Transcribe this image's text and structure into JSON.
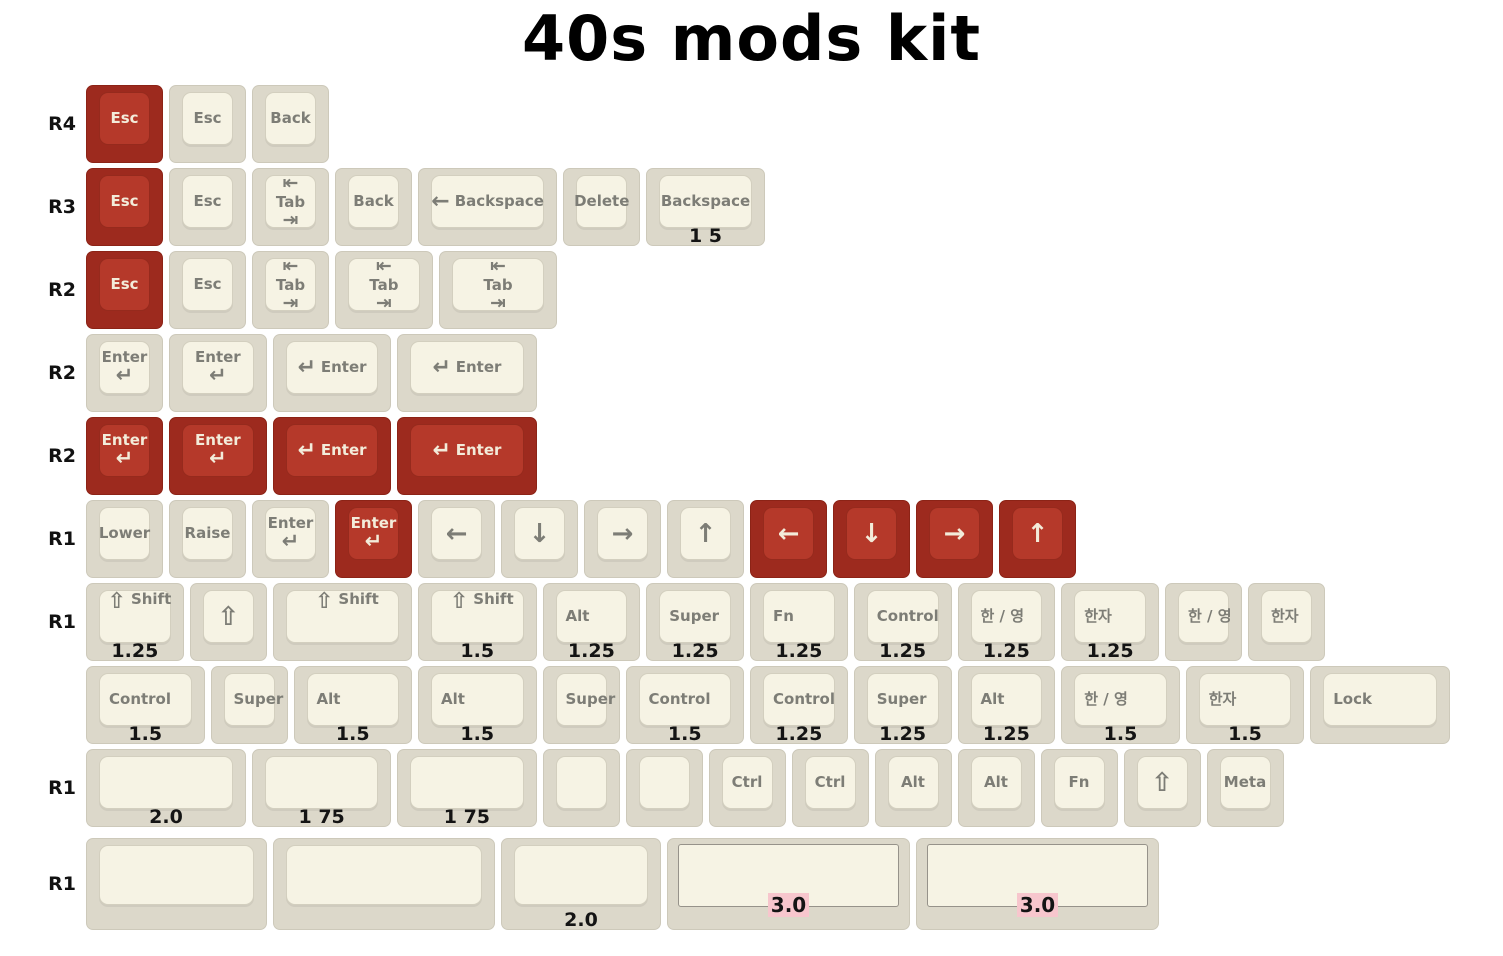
{
  "title": "40s mods kit",
  "colors": {
    "red_base": "#9d2a1e",
    "red_top": "#b5392a",
    "red_text": "#f3ecda",
    "cream_base": "#dcd8ca",
    "cream_top": "#f6f3e4",
    "cream_text": "#7d7d76",
    "size_label": "#141414",
    "label_highlight": "#f7c6cd",
    "title_text": "#000000",
    "background": "#ffffff"
  },
  "rows": [
    {
      "label": "R4",
      "keys": [
        {
          "name": "keycap-esc-red",
          "type": "text",
          "color": "red",
          "w": 1,
          "legend": "Esc"
        },
        {
          "name": "keycap-esc",
          "type": "text",
          "color": "cream",
          "w": 1,
          "legend": "Esc"
        },
        {
          "name": "keycap-back",
          "type": "text",
          "color": "cream",
          "w": 1,
          "legend": "Back"
        }
      ]
    },
    {
      "label": "R3",
      "keys": [
        {
          "name": "keycap-esc-red",
          "type": "text",
          "color": "red",
          "w": 1,
          "legend": "Esc"
        },
        {
          "name": "keycap-esc",
          "type": "text",
          "color": "cream",
          "w": 1,
          "legend": "Esc"
        },
        {
          "name": "keycap-tab",
          "type": "tab",
          "color": "cream",
          "w": 1,
          "legends": [
            "⇤",
            "Tab",
            "⇥"
          ]
        },
        {
          "name": "keycap-back",
          "type": "text",
          "color": "cream",
          "w": 1,
          "legend": "Back"
        },
        {
          "name": "keycap-backspace-arrow",
          "type": "combo",
          "color": "cream",
          "w": 1.75,
          "glyph": "←",
          "glyph_name": "backspace-arrow-icon",
          "legend": "Backspace"
        },
        {
          "name": "keycap-delete",
          "type": "text",
          "color": "cream",
          "w": 1,
          "legend": "Delete"
        },
        {
          "name": "keycap-backspace",
          "type": "text",
          "color": "cream",
          "w": 1.5,
          "legend": "Backspace",
          "sz": "1 5"
        }
      ]
    },
    {
      "label": "R2",
      "keys": [
        {
          "name": "keycap-esc-red",
          "type": "text",
          "color": "red",
          "w": 1,
          "legend": "Esc"
        },
        {
          "name": "keycap-esc",
          "type": "text",
          "color": "cream",
          "w": 1,
          "legend": "Esc"
        },
        {
          "name": "keycap-tab",
          "type": "tab",
          "color": "cream",
          "w": 1,
          "legends": [
            "⇤",
            "Tab",
            "⇥"
          ]
        },
        {
          "name": "keycap-tab",
          "type": "tab",
          "color": "cream",
          "w": 1.25,
          "legends": [
            "⇤",
            "Tab",
            "⇥"
          ]
        },
        {
          "name": "keycap-tab",
          "type": "tab",
          "color": "cream",
          "w": 1.5,
          "legends": [
            "⇤",
            "Tab",
            "⇥"
          ]
        }
      ]
    },
    {
      "label": "R2",
      "keys": [
        {
          "name": "keycap-enter",
          "type": "enter2",
          "color": "cream",
          "w": 1,
          "legend": "Enter",
          "glyph": "↵",
          "glyph_name": "return-arrow-icon"
        },
        {
          "name": "keycap-enter",
          "type": "enter2",
          "color": "cream",
          "w": 1.25,
          "legend": "Enter",
          "glyph": "↵",
          "glyph_name": "return-arrow-icon"
        },
        {
          "name": "keycap-enter",
          "type": "combo",
          "color": "cream",
          "w": 1.5,
          "glyph": "↵",
          "glyph_name": "return-arrow-icon",
          "legend": "Enter"
        },
        {
          "name": "keycap-enter",
          "type": "combo",
          "color": "cream",
          "w": 1.75,
          "glyph": "↵",
          "glyph_name": "return-arrow-icon",
          "legend": "Enter"
        }
      ]
    },
    {
      "label": "R2",
      "keys": [
        {
          "name": "keycap-enter-red",
          "type": "enter2",
          "color": "red",
          "w": 1,
          "legend": "Enter",
          "glyph": "↵",
          "glyph_name": "return-arrow-icon"
        },
        {
          "name": "keycap-enter-red",
          "type": "enter2",
          "color": "red",
          "w": 1.25,
          "legend": "Enter",
          "glyph": "↵",
          "glyph_name": "return-arrow-icon"
        },
        {
          "name": "keycap-enter-red",
          "type": "combo",
          "color": "red",
          "w": 1.5,
          "glyph": "↵",
          "glyph_name": "return-arrow-icon",
          "legend": "Enter"
        },
        {
          "name": "keycap-enter-red",
          "type": "combo",
          "color": "red",
          "w": 1.75,
          "glyph": "↵",
          "glyph_name": "return-arrow-icon",
          "legend": "Enter"
        }
      ]
    },
    {
      "label": "R1",
      "keys": [
        {
          "name": "keycap-lower",
          "type": "text",
          "color": "cream",
          "w": 1,
          "legend": "Lower"
        },
        {
          "name": "keycap-raise",
          "type": "text",
          "color": "cream",
          "w": 1,
          "legend": "Raise"
        },
        {
          "name": "keycap-enter",
          "type": "enter2",
          "color": "cream",
          "w": 1,
          "legend": "Enter",
          "glyph": "↵",
          "glyph_name": "return-arrow-icon"
        },
        {
          "name": "keycap-enter-red",
          "type": "enter2",
          "color": "red",
          "w": 1,
          "legend": "Enter",
          "glyph": "↵",
          "glyph_name": "return-arrow-icon"
        },
        {
          "name": "keycap-arrow-left",
          "type": "big",
          "color": "cream",
          "w": 1,
          "glyph": "←",
          "glyph_name": "left-arrow-icon"
        },
        {
          "name": "keycap-arrow-down",
          "type": "big",
          "color": "cream",
          "w": 1,
          "glyph": "↓",
          "glyph_name": "down-arrow-icon"
        },
        {
          "name": "keycap-arrow-right",
          "type": "big",
          "color": "cream",
          "w": 1,
          "glyph": "→",
          "glyph_name": "right-arrow-icon"
        },
        {
          "name": "keycap-arrow-up",
          "type": "big",
          "color": "cream",
          "w": 1,
          "glyph": "↑",
          "glyph_name": "up-arrow-icon"
        },
        {
          "name": "keycap-arrow-left-red",
          "type": "big",
          "color": "red",
          "w": 1,
          "glyph": "←",
          "glyph_name": "left-arrow-icon"
        },
        {
          "name": "keycap-arrow-down-red",
          "type": "big",
          "color": "red",
          "w": 1,
          "glyph": "↓",
          "glyph_name": "down-arrow-icon"
        },
        {
          "name": "keycap-arrow-right-red",
          "type": "big",
          "color": "red",
          "w": 1,
          "glyph": "→",
          "glyph_name": "right-arrow-icon"
        },
        {
          "name": "keycap-arrow-up-red",
          "type": "big",
          "color": "red",
          "w": 1,
          "glyph": "↑",
          "glyph_name": "up-arrow-icon"
        }
      ]
    },
    {
      "label": "R1",
      "keys": [
        {
          "name": "keycap-shift",
          "type": "combo",
          "color": "cream",
          "w": 1.25,
          "glyph": "⇧",
          "glyph_name": "shift-arrow-icon",
          "legend": "Shift",
          "sz": "1.25",
          "align": "left"
        },
        {
          "name": "keycap-shift-icon",
          "type": "big",
          "color": "cream",
          "w": 1,
          "glyph": "⇧",
          "glyph_name": "shift-arrow-icon"
        },
        {
          "name": "keycap-shift",
          "type": "combo",
          "color": "cream",
          "w": 1.75,
          "glyph": "⇧",
          "glyph_name": "shift-arrow-icon",
          "legend": "Shift",
          "align": "left"
        },
        {
          "name": "keycap-shift",
          "type": "combo",
          "color": "cream",
          "w": 1.5,
          "glyph": "⇧",
          "glyph_name": "shift-arrow-icon",
          "legend": "Shift",
          "sz": "1.5",
          "align": "left"
        },
        {
          "name": "keycap-alt",
          "type": "text",
          "color": "cream",
          "w": 1.25,
          "legend": "Alt",
          "sz": "1.25",
          "align": "left"
        },
        {
          "name": "keycap-super",
          "type": "text",
          "color": "cream",
          "w": 1.25,
          "legend": "Super",
          "sz": "1.25",
          "align": "left"
        },
        {
          "name": "keycap-fn",
          "type": "text",
          "color": "cream",
          "w": 1.25,
          "legend": "Fn",
          "sz": "1.25",
          "align": "left"
        },
        {
          "name": "keycap-control",
          "type": "text",
          "color": "cream",
          "w": 1.25,
          "legend": "Control",
          "sz": "1.25",
          "align": "left"
        },
        {
          "name": "keycap-han-yeong",
          "type": "text",
          "color": "cream",
          "w": 1.25,
          "legend": "한 / 영",
          "sz": "1.25",
          "align": "left"
        },
        {
          "name": "keycap-hanja",
          "type": "text",
          "color": "cream",
          "w": 1.25,
          "legend": "한자",
          "sz": "1.25",
          "align": "left"
        },
        {
          "name": "keycap-han-yeong",
          "type": "text",
          "color": "cream",
          "w": 1,
          "legend": "한 / 영",
          "align": "left"
        },
        {
          "name": "keycap-hanja",
          "type": "text",
          "color": "cream",
          "w": 1,
          "legend": "한자",
          "align": "left"
        }
      ]
    },
    {
      "label": "",
      "keys": [
        {
          "name": "keycap-control",
          "type": "text",
          "color": "cream",
          "w": 1.5,
          "legend": "Control",
          "sz": "1.5",
          "align": "left"
        },
        {
          "name": "keycap-super",
          "type": "text",
          "color": "cream",
          "w": 1,
          "legend": "Super",
          "align": "left"
        },
        {
          "name": "keycap-alt",
          "type": "text",
          "color": "cream",
          "w": 1.5,
          "legend": "Alt",
          "sz": "1.5",
          "align": "left"
        },
        {
          "name": "keycap-alt",
          "type": "text",
          "color": "cream",
          "w": 1.5,
          "legend": "Alt",
          "sz": "1.5",
          "align": "left"
        },
        {
          "name": "keycap-super",
          "type": "text",
          "color": "cream",
          "w": 1,
          "legend": "Super",
          "align": "left"
        },
        {
          "name": "keycap-control",
          "type": "text",
          "color": "cream",
          "w": 1.5,
          "legend": "Control",
          "sz": "1.5",
          "align": "left"
        },
        {
          "name": "keycap-control",
          "type": "text",
          "color": "cream",
          "w": 1.25,
          "legend": "Control",
          "sz": "1.25",
          "align": "left"
        },
        {
          "name": "keycap-super",
          "type": "text",
          "color": "cream",
          "w": 1.25,
          "legend": "Super",
          "sz": "1.25",
          "align": "left"
        },
        {
          "name": "keycap-alt",
          "type": "text",
          "color": "cream",
          "w": 1.25,
          "legend": "Alt",
          "sz": "1.25",
          "align": "left"
        },
        {
          "name": "keycap-han-yeong",
          "type": "text",
          "color": "cream",
          "w": 1.5,
          "legend": "한 / 영",
          "sz": "1.5",
          "align": "left"
        },
        {
          "name": "keycap-hanja",
          "type": "text",
          "color": "cream",
          "w": 1.5,
          "legend": "한자",
          "sz": "1.5",
          "align": "left"
        },
        {
          "name": "keycap-lock",
          "type": "text",
          "color": "cream",
          "w": 1.75,
          "legend": "Lock",
          "align": "left"
        }
      ]
    },
    {
      "label": "R1",
      "keys": [
        {
          "name": "keycap-blank",
          "type": "blank",
          "color": "cream",
          "w": 2,
          "sz": "2.0"
        },
        {
          "name": "keycap-blank",
          "type": "blank",
          "color": "cream",
          "w": 1.75,
          "sz": "1 75"
        },
        {
          "name": "keycap-blank",
          "type": "blank",
          "color": "cream",
          "w": 1.75,
          "sz": "1 75"
        },
        {
          "name": "keycap-blank",
          "type": "blank",
          "color": "cream",
          "w": 1
        },
        {
          "name": "keycap-blank",
          "type": "blank",
          "color": "cream",
          "w": 1
        },
        {
          "name": "keycap-ctrl",
          "type": "text",
          "color": "cream",
          "w": 1,
          "legend": "Ctrl"
        },
        {
          "name": "keycap-ctrl",
          "type": "text",
          "color": "cream",
          "w": 1,
          "legend": "Ctrl"
        },
        {
          "name": "keycap-alt",
          "type": "text",
          "color": "cream",
          "w": 1,
          "legend": "Alt"
        },
        {
          "name": "keycap-alt",
          "type": "text",
          "color": "cream",
          "w": 1,
          "legend": "Alt"
        },
        {
          "name": "keycap-fn",
          "type": "text",
          "color": "cream",
          "w": 1,
          "legend": "Fn"
        },
        {
          "name": "keycap-shift-icon",
          "type": "big",
          "color": "cream",
          "w": 1,
          "glyph": "⇧",
          "glyph_name": "shift-arrow-icon"
        },
        {
          "name": "keycap-meta",
          "type": "text",
          "color": "cream",
          "w": 1,
          "legend": "Meta"
        }
      ]
    },
    {
      "label": "R1",
      "keys": [
        {
          "name": "keycap-blank",
          "type": "blank",
          "color": "cream",
          "w": 2.25
        },
        {
          "name": "keycap-blank",
          "type": "blank",
          "color": "cream",
          "w": 2.75
        },
        {
          "name": "keycap-blank",
          "type": "blank",
          "color": "cream",
          "w": 2,
          "sz": "2.0"
        },
        {
          "name": "keycap-spacebar",
          "type": "space",
          "color": "cream",
          "w": 3,
          "inner": "3.0"
        },
        {
          "name": "keycap-spacebar",
          "type": "space",
          "color": "cream",
          "w": 3,
          "inner": "3.0"
        }
      ]
    }
  ]
}
